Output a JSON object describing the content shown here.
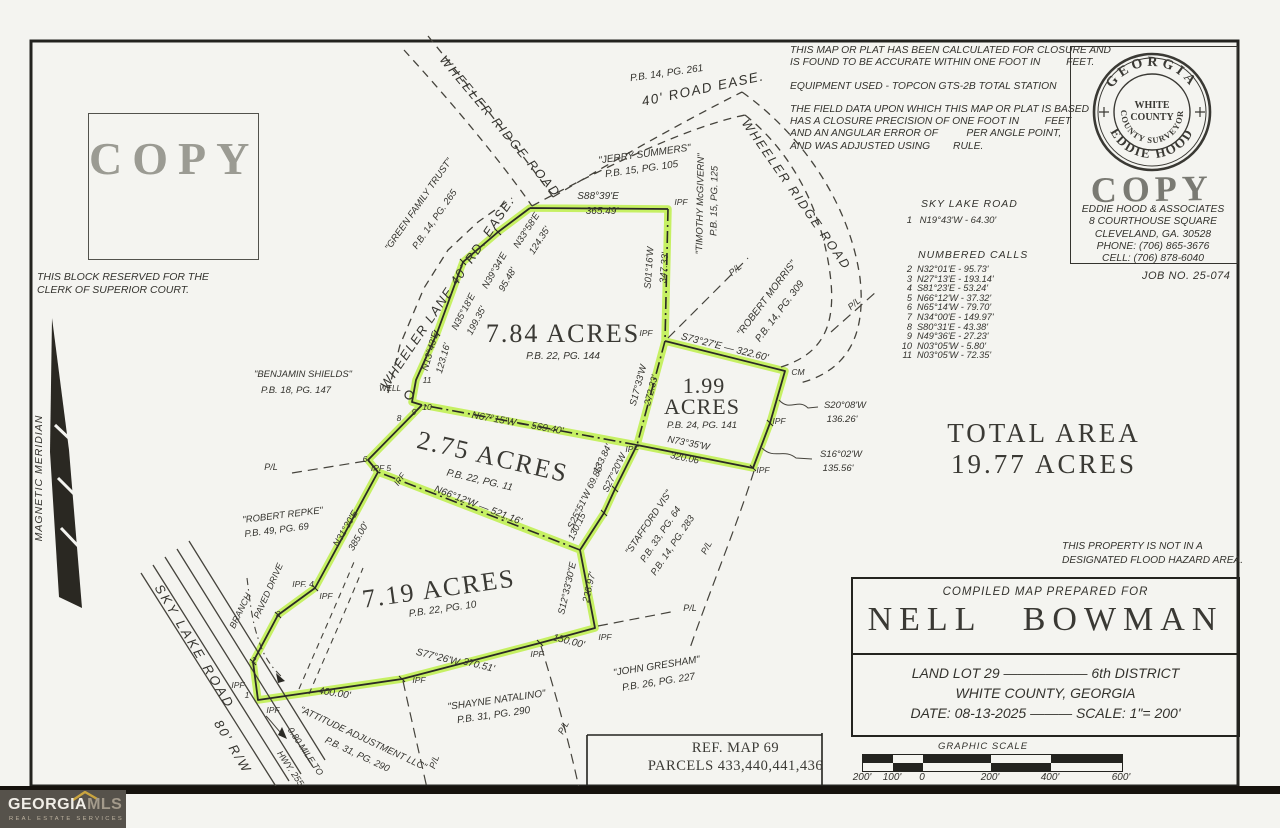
{
  "page": {
    "copy_stamp": "COPY",
    "clerk_note_1": "THIS BLOCK RESERVED FOR THE",
    "clerk_note_2": "CLERK OF SUPERIOR COURT.",
    "job_no": "JOB NO. 25-074",
    "total_area_1": "TOTAL AREA",
    "total_area_2": "19.77 ACRES",
    "flood_note_1": "THIS PROPERTY IS NOT IN A",
    "flood_note_2": "DESIGNATED FLOOD HAZARD AREA.",
    "ref_line_1": "REF. MAP 69",
    "ref_line_2": "PARCELS 433,440,441,436"
  },
  "disclaimer": {
    "lines": [
      "THIS MAP OR PLAT HAS BEEN CALCULATED FOR CLOSURE AND",
      "IS FOUND TO BE ACCURATE WITHIN ONE FOOT IN         FEET.",
      "EQUIPMENT USED - TOPCON GTS-2B TOTAL STATION",
      "THE FIELD DATA UPON WHICH THIS MAP OR PLAT IS BASED",
      "HAS A CLOSURE PRECISION OF ONE FOOT IN         FEET",
      "AND AN ANGULAR ERROR OF          PER ANGLE POINT,",
      "AND WAS ADJUSTED USING        RULE."
    ]
  },
  "seal": {
    "arc_top": "GEORGIA",
    "arc_bottom": "EDDIE HOOD",
    "arc_inner": "COUNTY SURVEYOR",
    "inner_line_1": "WHITE",
    "inner_line_2": "COUNTY",
    "copy_stamp": "COPY",
    "address": [
      "EDDIE HOOD & ASSOCIATES",
      "8 COURTHOUSE SQUARE",
      "CLEVELAND, GA. 30528",
      "PHONE: (706) 865-3676",
      "CELL: (706) 878-6040"
    ]
  },
  "calls": {
    "road_title": "SKY LAKE ROAD",
    "first_num": "1",
    "first_text": "N19°43'W - 64.30'",
    "list_title": "NUMBERED CALLS",
    "rows": [
      [
        "2",
        "N32°01'E - 95.73'"
      ],
      [
        "3",
        "N27°13'E - 193.14'"
      ],
      [
        "4",
        "S81°23'E - 53.24'"
      ],
      [
        "5",
        "N66°12'W - 37.32'"
      ],
      [
        "6",
        "N65°14'W - 79.70'"
      ],
      [
        "7",
        "N34°00'E - 149.97'"
      ],
      [
        "8",
        "S80°31'E - 43.38'"
      ],
      [
        "9",
        "N49°36'E - 27.23'"
      ],
      [
        "10",
        "N03°05'W - 5.80'"
      ],
      [
        "11",
        "N03°05'W - 72.35'"
      ]
    ]
  },
  "title_block": {
    "prepared_for": "COMPILED MAP PREPARED FOR",
    "owner": "NELL BOWMAN",
    "line_lot": "LAND LOT 29 —————— 6th DISTRICT",
    "line_county": "WHITE COUNTY,  GEORGIA",
    "line_date": "DATE: 08-13-2025 ——— SCALE: 1\"= 200'"
  },
  "graphic_scale": {
    "title": "GRAPHIC SCALE",
    "ticks": [
      "200'",
      "100'",
      "0",
      "200'",
      "400'",
      "600'"
    ]
  },
  "logo": {
    "brand_1": "GEORGIA",
    "brand_2": "MLS",
    "tagline": "REAL ESTATE SERVICES"
  },
  "map": {
    "labels": [
      {
        "n": "road-label-wheeler-ridge-road-west",
        "t": "WHEELER RIDGE ROAD",
        "x": 497,
        "y": 129,
        "r": 50,
        "s": 12.5,
        "ls": 2
      },
      {
        "n": "road-label-wheeler-ridge-road-east",
        "t": "WHEELER RIDGE ROAD",
        "x": 793,
        "y": 197,
        "r": 55,
        "s": 12.5,
        "ls": 2
      },
      {
        "n": "road-label-40-road-ease",
        "t": "40' ROAD EASE.",
        "x": 704,
        "y": 93,
        "r": -12,
        "s": 13.5,
        "ls": 1.5
      },
      {
        "n": "plat-ref-label",
        "t": "P.B. 14, PG. 261",
        "x": 667,
        "y": 76,
        "r": -8,
        "s": 10
      },
      {
        "n": "road-label-wheeler-lane",
        "t": "WHEELER LANE  40' RD. EASE.",
        "x": 451,
        "y": 295,
        "r": -56,
        "s": 13,
        "ls": 1.5
      },
      {
        "n": "road-label-sky-lake-road",
        "t": "SKY LAKE ROAD",
        "x": 191,
        "y": 649,
        "r": 59,
        "s": 13,
        "ls": 3
      },
      {
        "n": "road-label-80-rw",
        "t": "80' R/W",
        "x": 229,
        "y": 749,
        "r": 59,
        "s": 13,
        "ls": 2
      },
      {
        "n": "note-mile-to-hwy-1",
        "t": "0.80 MILE TO",
        "x": 303,
        "y": 753,
        "r": 56,
        "s": 9
      },
      {
        "n": "note-mile-to-hwy-2",
        "t": "HWY. 255",
        "x": 288,
        "y": 770,
        "r": 56,
        "s": 9
      },
      {
        "n": "label-branch",
        "t": "BRANCH",
        "x": 243,
        "y": 612,
        "r": -64,
        "s": 9
      },
      {
        "n": "label-paved-drive",
        "t": "PAVED DRIVE",
        "x": 271,
        "y": 592,
        "r": -66,
        "s": 9
      },
      {
        "n": "label-magnetic-meridian",
        "t": "MAGNETIC MERIDIAN",
        "x": 42,
        "y": 478,
        "r": -90,
        "s": 10.5,
        "ls": 1
      },
      {
        "n": "neighbor-label",
        "t": "\"GREEN FAMILY TRUST\"",
        "x": 421,
        "y": 206,
        "r": -55,
        "s": 9.5
      },
      {
        "n": "plat-ref-label",
        "t": "P.B. 14, PG. 265",
        "x": 437,
        "y": 221,
        "r": -55,
        "s": 9.5
      },
      {
        "n": "neighbor-label",
        "t": "\"JERRY SUMMERS\"",
        "x": 645,
        "y": 157,
        "r": -8,
        "s": 10
      },
      {
        "n": "plat-ref-label",
        "t": "P.B. 15, PG. 105",
        "x": 642,
        "y": 172,
        "r": -8,
        "s": 10
      },
      {
        "n": "neighbor-label",
        "t": "\"TIMOTHY McGIVERN\"",
        "x": 703,
        "y": 204,
        "r": -89,
        "s": 9.5
      },
      {
        "n": "plat-ref-label",
        "t": "P.B. 15, PG. 125",
        "x": 717,
        "y": 201,
        "r": -89,
        "s": 9.5
      },
      {
        "n": "neighbor-label",
        "t": "\"ROBERT MORRIS\"",
        "x": 769,
        "y": 300,
        "r": -53,
        "s": 10
      },
      {
        "n": "plat-ref-label",
        "t": "P.B. 14, PG. 309",
        "x": 782,
        "y": 313,
        "r": -53,
        "s": 10
      },
      {
        "n": "neighbor-label",
        "t": "\"BENJAMIN SHIELDS\"",
        "x": 303,
        "y": 377,
        "s": 9.5
      },
      {
        "n": "plat-ref-label",
        "t": "P.B. 18, PG. 147",
        "x": 296,
        "y": 393,
        "s": 9.5
      },
      {
        "n": "neighbor-label",
        "t": "\"ROBERT REPKE\"",
        "x": 283,
        "y": 518,
        "r": -7,
        "s": 9.5
      },
      {
        "n": "plat-ref-label",
        "t": "P.B. 49, PG. 69",
        "x": 277,
        "y": 533,
        "r": -7,
        "s": 9.5
      },
      {
        "n": "neighbor-label",
        "t": "\"STAFFORD VIS\"",
        "x": 651,
        "y": 524,
        "r": -56,
        "s": 9.5
      },
      {
        "n": "plat-ref-label",
        "t": "P.B. 33, PG. 64",
        "x": 663,
        "y": 536,
        "r": -56,
        "s": 9.5
      },
      {
        "n": "plat-ref-label",
        "t": "P.B. 14, PG. 283",
        "x": 675,
        "y": 547,
        "r": -56,
        "s": 9.5
      },
      {
        "n": "neighbor-label",
        "t": "\"JOHN GRESHAM\"",
        "x": 657,
        "y": 669,
        "r": -9,
        "s": 10
      },
      {
        "n": "plat-ref-label",
        "t": "P.B. 26, PG. 227",
        "x": 659,
        "y": 685,
        "r": -9,
        "s": 10
      },
      {
        "n": "neighbor-label",
        "t": "\"SHAYNE NATALINO\"",
        "x": 497,
        "y": 703,
        "r": -8,
        "s": 10
      },
      {
        "n": "plat-ref-label",
        "t": "P.B. 31, PG. 290",
        "x": 494,
        "y": 718,
        "r": -8,
        "s": 10
      },
      {
        "n": "neighbor-label",
        "t": "\"ATTITUDE ADJUSTMENT LLC\"",
        "x": 362,
        "y": 741,
        "r": 25,
        "s": 9.5
      },
      {
        "n": "plat-ref-label",
        "t": "P.B. 31, PG. 290",
        "x": 356,
        "y": 757,
        "r": 25,
        "s": 9.5
      },
      {
        "n": "bearing-label",
        "t": "S88°39'E",
        "x": 598,
        "y": 199,
        "s": 10
      },
      {
        "n": "distance-label",
        "t": "365.49'",
        "x": 602,
        "y": 214,
        "s": 10
      },
      {
        "n": "bearing-label",
        "t": "N33°58'E",
        "x": 529,
        "y": 232,
        "r": -57,
        "s": 9.5
      },
      {
        "n": "distance-label",
        "t": "124.35'",
        "x": 542,
        "y": 242,
        "r": -57,
        "s": 9.5
      },
      {
        "n": "bearing-label",
        "t": "N39°34'E",
        "x": 497,
        "y": 272,
        "r": -60,
        "s": 9.5
      },
      {
        "n": "distance-label",
        "t": "95.48'",
        "x": 510,
        "y": 281,
        "r": -60,
        "s": 9.5
      },
      {
        "n": "bearing-label",
        "t": "N35°18'E",
        "x": 466,
        "y": 313,
        "r": -62,
        "s": 9.5
      },
      {
        "n": "distance-label",
        "t": "199.35'",
        "x": 479,
        "y": 322,
        "r": -62,
        "s": 9.5
      },
      {
        "n": "bearing-label",
        "t": "N13°43'E",
        "x": 433,
        "y": 352,
        "r": -74,
        "s": 9.5
      },
      {
        "n": "distance-label",
        "t": "123.16'",
        "x": 446,
        "y": 359,
        "r": -74,
        "s": 9.5
      },
      {
        "n": "bearing-label",
        "t": "S01°16'W",
        "x": 652,
        "y": 268,
        "r": -86,
        "s": 9.5
      },
      {
        "n": "distance-label",
        "t": "347.33'",
        "x": 667,
        "y": 268,
        "r": -86,
        "s": 9.5
      },
      {
        "n": "bearing-label",
        "t": "S73°27'E — 322.60'",
        "x": 724,
        "y": 350,
        "r": 14,
        "s": 10
      },
      {
        "n": "bearing-label",
        "t": "S17°33'W",
        "x": 641,
        "y": 386,
        "r": -75,
        "s": 9.5
      },
      {
        "n": "distance-label",
        "t": "272.33'",
        "x": 654,
        "y": 391,
        "r": -75,
        "s": 9.5
      },
      {
        "n": "bearing-label",
        "t": "S27°20'W",
        "x": 617,
        "y": 474,
        "r": -64,
        "s": 9.5
      },
      {
        "n": "distance-label",
        "t": "133.84'",
        "x": 605,
        "y": 460,
        "r": -64,
        "s": 9.5
      },
      {
        "n": "bearing-label",
        "t": "S25°51'W 69.85'",
        "x": 588,
        "y": 498,
        "r": -64,
        "s": 9.5
      },
      {
        "n": "distance-label",
        "t": "130.15'",
        "x": 580,
        "y": 527,
        "r": -64,
        "s": 9.5
      },
      {
        "n": "bearing-label",
        "t": "S12°33'30\"E",
        "x": 570,
        "y": 589,
        "r": -77,
        "s": 9.5
      },
      {
        "n": "distance-label",
        "t": "228.97'",
        "x": 592,
        "y": 588,
        "r": -77,
        "s": 9.5
      },
      {
        "n": "distance-label",
        "t": "150.00'",
        "x": 568,
        "y": 644,
        "r": 14,
        "s": 10
      },
      {
        "n": "bearing-label",
        "t": "S77°26'W",
        "x": 437,
        "y": 660,
        "r": 14,
        "s": 10
      },
      {
        "n": "distance-label",
        "t": "370.51'",
        "x": 478,
        "y": 668,
        "r": 14,
        "s": 10
      },
      {
        "n": "distance-label",
        "t": "400.00'",
        "x": 334,
        "y": 696,
        "r": 9,
        "s": 10
      },
      {
        "n": "bearing-label",
        "t": "N31°30'E",
        "x": 348,
        "y": 530,
        "r": -60,
        "s": 9.5
      },
      {
        "n": "distance-label",
        "t": "385.00'",
        "x": 361,
        "y": 538,
        "r": -60,
        "s": 9.5
      },
      {
        "n": "bearing-label",
        "t": "N67°15'W — 569.40'",
        "x": 517,
        "y": 426,
        "r": 10,
        "s": 10
      },
      {
        "n": "bearing-label",
        "t": "N66°12'W — 521.16'",
        "x": 477,
        "y": 508,
        "r": 21,
        "s": 10
      },
      {
        "n": "bearing-label",
        "t": "N73°35'W",
        "x": 688,
        "y": 446,
        "r": 11,
        "s": 9.5
      },
      {
        "n": "distance-label",
        "t": "320.06'",
        "x": 685,
        "y": 461,
        "r": 11,
        "s": 9.5
      },
      {
        "n": "bearing-label",
        "t": "S20°08'W",
        "x": 845,
        "y": 408,
        "s": 9.5
      },
      {
        "n": "distance-label",
        "t": "136.26'",
        "x": 842,
        "y": 422,
        "s": 9.5
      },
      {
        "n": "bearing-label",
        "t": "S16°02'W",
        "x": 841,
        "y": 457,
        "s": 9.5
      },
      {
        "n": "distance-label",
        "t": "135.56'",
        "x": 838,
        "y": 471,
        "s": 9.5
      },
      {
        "n": "parcel-area-label",
        "t": "7.84 ACRES",
        "x": 563,
        "y": 342,
        "s": 26,
        "f": "r",
        "ls": 2
      },
      {
        "n": "plat-ref-label",
        "t": "P.B. 22, PG. 144",
        "x": 563,
        "y": 359,
        "s": 10
      },
      {
        "n": "parcel-area-label",
        "t": "1.99",
        "x": 704,
        "y": 393,
        "s": 22,
        "f": "r",
        "ls": 1
      },
      {
        "n": "parcel-area-label",
        "t": "ACRES",
        "x": 702,
        "y": 414,
        "s": 22,
        "f": "r",
        "ls": 1
      },
      {
        "n": "plat-ref-label",
        "t": "P.B. 24, PG. 141",
        "x": 702,
        "y": 428,
        "s": 9.5
      },
      {
        "n": "parcel-area-label",
        "t": "2.75 ACRES",
        "x": 491,
        "y": 465,
        "r": 13,
        "s": 26,
        "f": "r",
        "ls": 2
      },
      {
        "n": "plat-ref-label",
        "t": "P.B. 22, PG. 11",
        "x": 479,
        "y": 483,
        "r": 13,
        "s": 10
      },
      {
        "n": "parcel-area-label",
        "t": "7.19 ACRES",
        "x": 440,
        "y": 597,
        "r": -8,
        "s": 26,
        "f": "r",
        "ls": 2
      },
      {
        "n": "plat-ref-label",
        "t": "P.B. 22, PG. 10",
        "x": 443,
        "y": 612,
        "r": -8,
        "s": 10
      },
      {
        "n": "marker-ipf",
        "t": "IPF",
        "x": 681,
        "y": 205,
        "s": 8.5
      },
      {
        "n": "marker-ipf",
        "t": "IPF",
        "x": 646,
        "y": 336,
        "s": 8.5
      },
      {
        "n": "marker-cm",
        "t": "CM",
        "x": 798,
        "y": 375,
        "s": 8.5
      },
      {
        "n": "marker-ipf",
        "t": "IPF",
        "x": 779,
        "y": 424,
        "s": 8.5
      },
      {
        "n": "marker-ipf",
        "t": "IPF",
        "x": 763,
        "y": 473,
        "s": 8.5
      },
      {
        "n": "marker-ipf",
        "t": "IPF",
        "x": 632,
        "y": 452,
        "s": 8.5
      },
      {
        "n": "marker-ipf",
        "t": "IPF  5",
        "x": 381,
        "y": 471,
        "s": 8.5
      },
      {
        "n": "marker-ipf",
        "t": "IPF",
        "x": 402,
        "y": 481,
        "r": -55,
        "s": 8.5
      },
      {
        "n": "vertex-number",
        "t": "6",
        "x": 365,
        "y": 462,
        "s": 8.5
      },
      {
        "n": "vertex-number",
        "t": "8",
        "x": 399,
        "y": 421,
        "s": 8.5
      },
      {
        "n": "vertex-number",
        "t": "9",
        "x": 414,
        "y": 415,
        "s": 8.5
      },
      {
        "n": "vertex-number",
        "t": "10",
        "x": 427,
        "y": 410,
        "s": 8.5
      },
      {
        "n": "vertex-number",
        "t": "11",
        "x": 427,
        "y": 383,
        "s": 8.5
      },
      {
        "n": "marker-well",
        "t": "WELL",
        "x": 390,
        "y": 391,
        "s": 8
      },
      {
        "n": "marker-ipf",
        "t": "IPF. 4",
        "x": 303,
        "y": 587,
        "s": 8.5
      },
      {
        "n": "marker-ipf",
        "t": "IPF",
        "x": 326,
        "y": 599,
        "s": 8.5
      },
      {
        "n": "vertex-number",
        "t": "3",
        "x": 278,
        "y": 617,
        "s": 8.5
      },
      {
        "n": "vertex-number",
        "t": "2",
        "x": 254,
        "y": 663,
        "s": 8.5
      },
      {
        "n": "vertex-number",
        "t": "1",
        "x": 247,
        "y": 698,
        "s": 8.5
      },
      {
        "n": "marker-ipf",
        "t": "IPF",
        "x": 238,
        "y": 688,
        "s": 8.5
      },
      {
        "n": "marker-ipf",
        "t": "IPF",
        "x": 273,
        "y": 713,
        "s": 8.5
      },
      {
        "n": "marker-ipf",
        "t": "IPF",
        "x": 419,
        "y": 683,
        "s": 8.5
      },
      {
        "n": "marker-ipf",
        "t": "IPF",
        "x": 537,
        "y": 657,
        "s": 8.5
      },
      {
        "n": "marker-ipf",
        "t": "IPF",
        "x": 605,
        "y": 640,
        "s": 8.5
      },
      {
        "n": "pl-label",
        "t": "P/L",
        "x": 737,
        "y": 272,
        "r": -40,
        "s": 9
      },
      {
        "n": "pl-label",
        "t": "P/L",
        "x": 856,
        "y": 306,
        "r": -40,
        "s": 9
      },
      {
        "n": "pl-label",
        "t": "P/L",
        "x": 271,
        "y": 470,
        "s": 9
      },
      {
        "n": "pl-label",
        "t": "P/L",
        "x": 690,
        "y": 611,
        "s": 9
      },
      {
        "n": "pl-label",
        "t": "P/L",
        "x": 709,
        "y": 549,
        "r": -62,
        "s": 9
      },
      {
        "n": "pl-label",
        "t": "P/L",
        "x": 566,
        "y": 729,
        "r": -62,
        "s": 9
      },
      {
        "n": "pl-label",
        "t": "P/L",
        "x": 437,
        "y": 763,
        "r": -70,
        "s": 9
      }
    ]
  }
}
